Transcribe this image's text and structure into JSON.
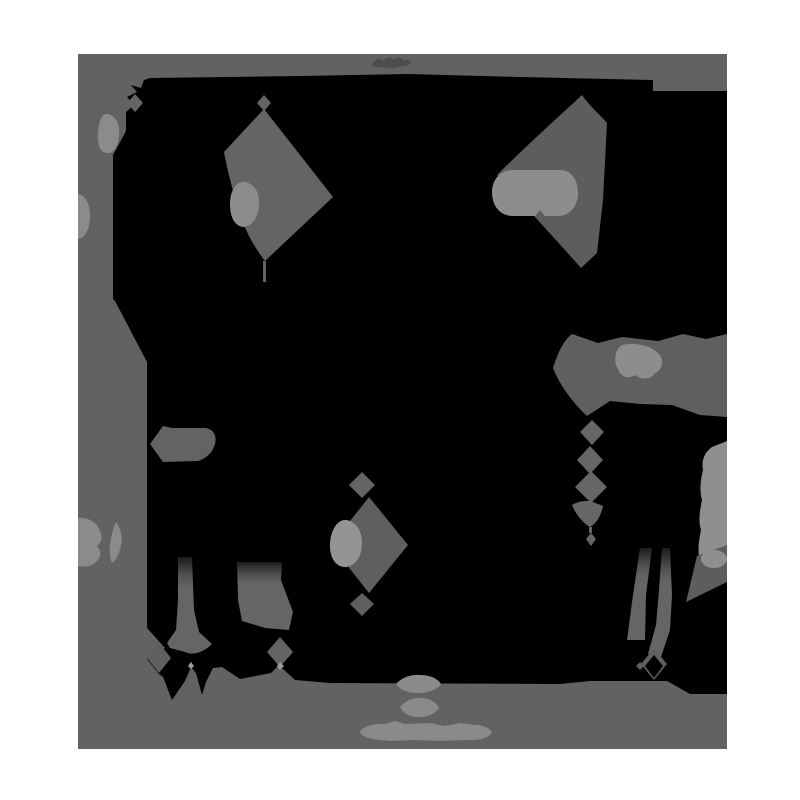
{
  "image": {
    "kind": "posterized-photograph",
    "subject": "dark animal silhouette with two pointed ears and thin legs standing on a plain floor, reduced to flat black and gray tone regions",
    "framing": "gray photo rectangle centered on a white page margin",
    "watermark": {
      "present": true,
      "legible": false,
      "lines": 3,
      "position": "bottom-center"
    }
  },
  "palette": {
    "white": "#ffffff",
    "photo_bg": "#626262",
    "black": "#000000",
    "ear_gray": "#646464",
    "right_ear_gray": "#5d5d5d",
    "shape_gray": "#5f5f5f",
    "mid_gray": "#666666",
    "bubble_gray": "#636363",
    "light_gray": "#8b8b8b",
    "pill_light": "#8d8d8d",
    "oval_light": "#949494",
    "wall_light": "#8f8f8f",
    "dot_light": "#9c9c9c",
    "watermark_gray": "#8a8a8a",
    "wisp_gray": "#4d4d4d",
    "leg_grad_top": "#1c1c1c",
    "leg_grad_mid": "#4f4f4f",
    "leg_grad_end": "#656565"
  }
}
